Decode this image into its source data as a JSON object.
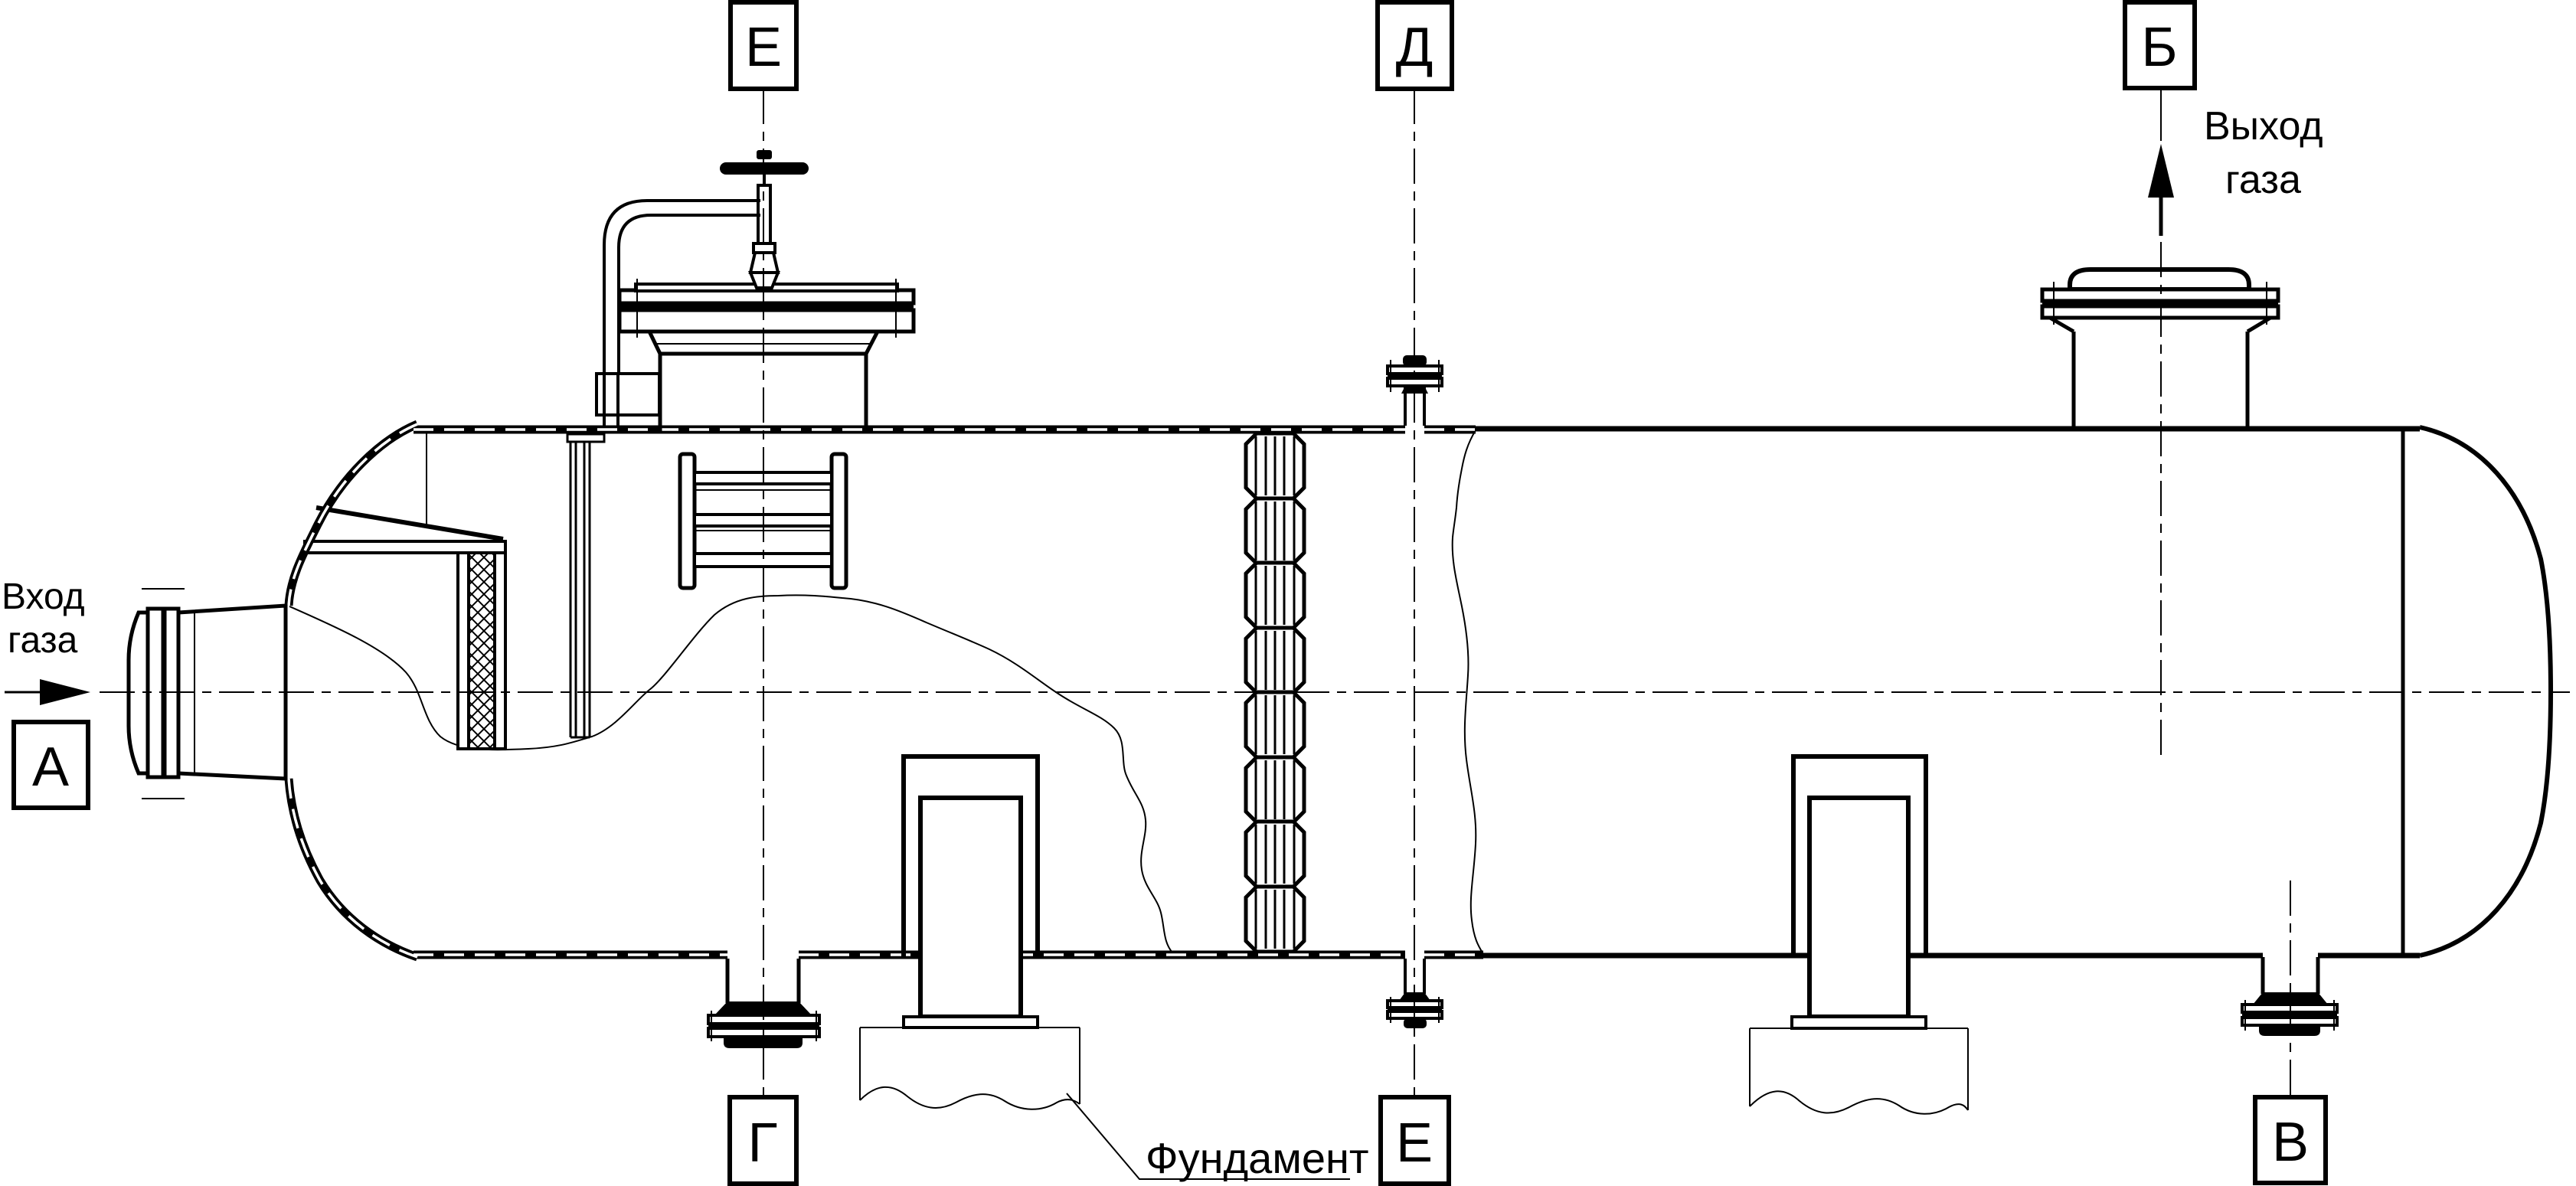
{
  "markers": {
    "top": [
      {
        "letter": "Е"
      },
      {
        "letter": "Д"
      },
      {
        "letter": "Б"
      }
    ],
    "bottom": [
      {
        "letter": "Г"
      },
      {
        "letter": "Е"
      },
      {
        "letter": "В"
      }
    ],
    "inlet": {
      "letter": "А"
    }
  },
  "flow": {
    "inlet": {
      "line1": "Вход",
      "line2": "газа"
    },
    "outlet": {
      "line1": "Выход",
      "line2": "газа"
    }
  },
  "foundation": {
    "label": "Фундамент"
  },
  "colors": {
    "line": "#000000",
    "background": "#ffffff"
  }
}
